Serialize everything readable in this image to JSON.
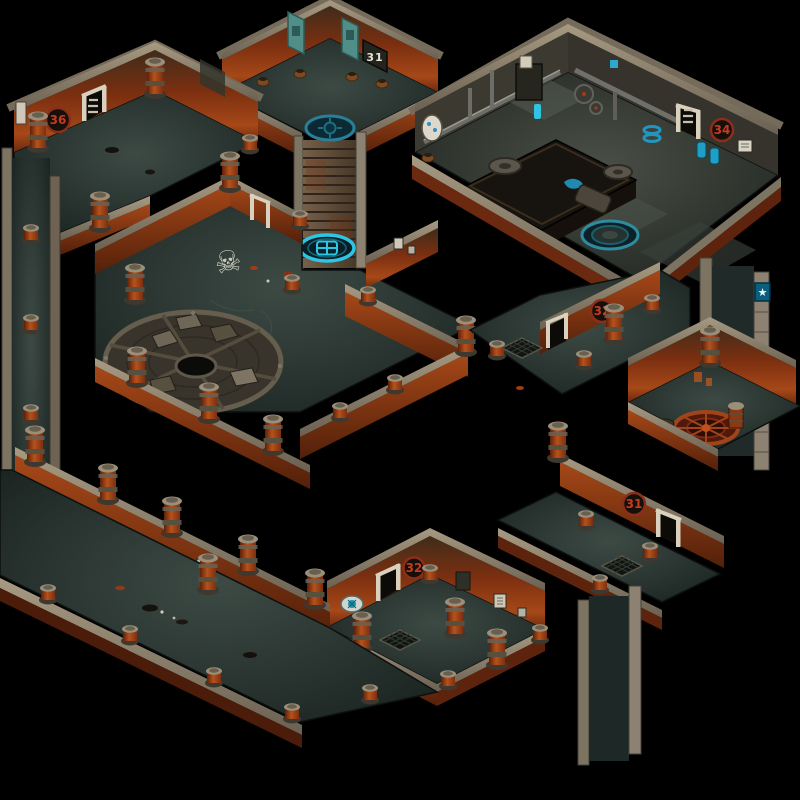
{
  "scene": {
    "kind": "isometric sewer dungeon level map",
    "background": "#000000",
    "width": 800,
    "height": 800
  },
  "palette": {
    "wall_rust": "#a64818",
    "wall_rust_dark": "#5e230c",
    "stone": "#7d7361",
    "stone_light": "#a79a82",
    "floor_teal": "#2c3733",
    "accent_cyan": "#2ec4e4",
    "teal_sign": "#0a5e7e",
    "badge_red": "#c23c22",
    "wood_plank": "#75604a",
    "banner_teal": "#518e88",
    "emblem_red": "#a1441c",
    "machine_blue": "#1f9fc6"
  },
  "doors": [
    {
      "id": "northwest-room",
      "label": "36"
    },
    {
      "id": "machine-room",
      "label": "34"
    },
    {
      "id": "east-hall",
      "label": "32"
    },
    {
      "id": "southeast-hall",
      "label": "31"
    },
    {
      "id": "south-room",
      "label": "32"
    }
  ],
  "wall_plate": {
    "label": "31"
  },
  "glyphs": {
    "skull": "☠",
    "star": "★"
  }
}
